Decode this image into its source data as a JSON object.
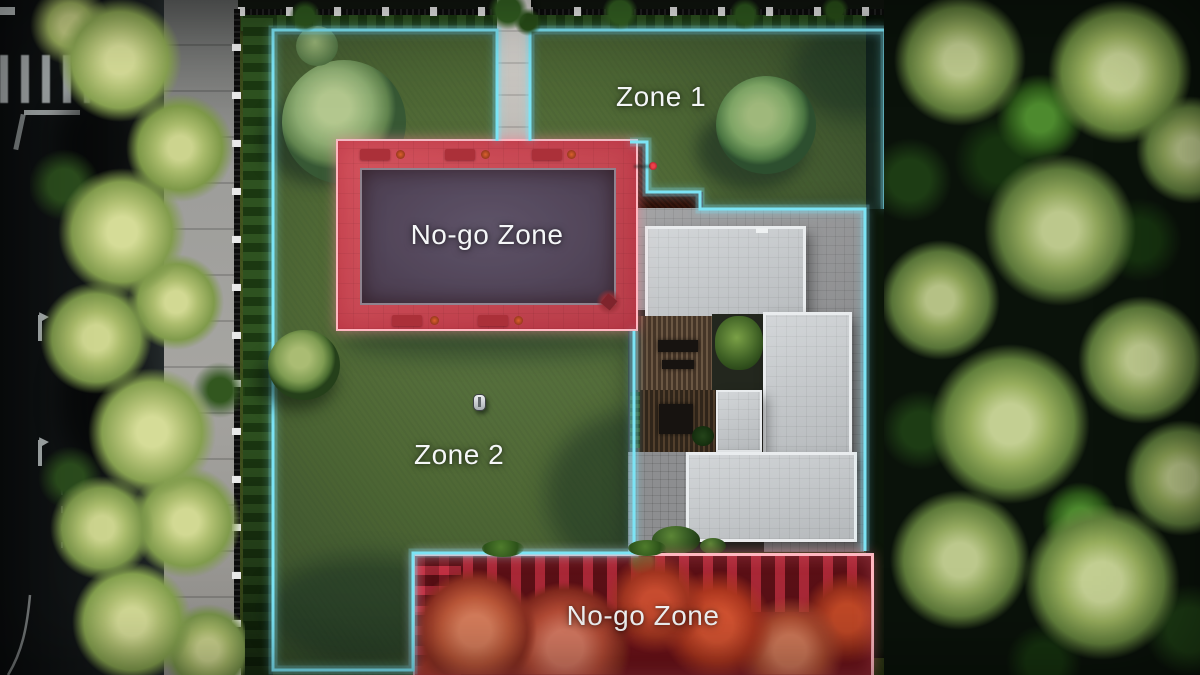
{
  "labels": {
    "zone1": "Zone 1",
    "zone2": "Zone 2",
    "no_go_pool": "No-go Zone",
    "no_go_garden": "No-go Zone"
  },
  "theme": {
    "zone_border": "#7ce4f5",
    "zone_fill": "rgba(130,215,235,0.10)",
    "no_go_border": "#ffb7c0",
    "no_go_fill": "#e23a4e",
    "label_color": "#f5f7f8"
  }
}
